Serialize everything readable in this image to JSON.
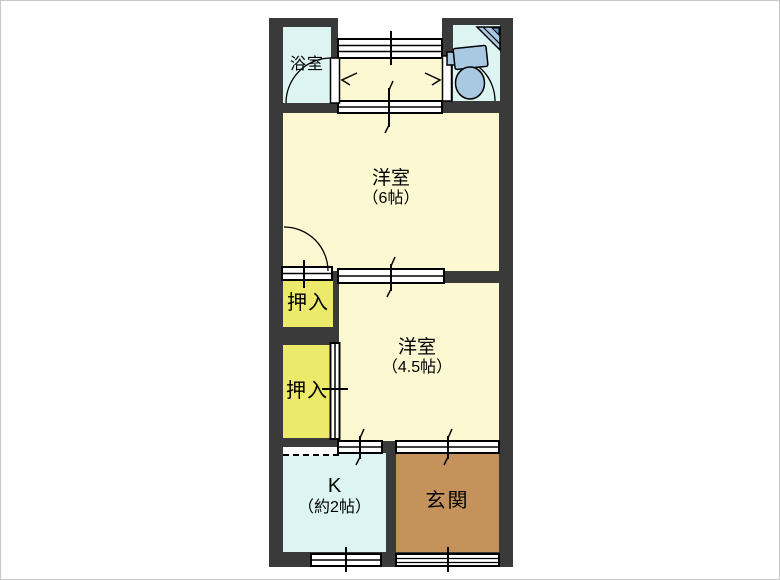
{
  "plan": {
    "type": "japanese-apartment-floorplan",
    "rooms": {
      "bathroom": {
        "label": "浴室"
      },
      "western6": {
        "name": "洋室",
        "size": "（6帖）"
      },
      "closet_upper": {
        "label": "押入"
      },
      "closet_lower": {
        "label": "押入"
      },
      "western45": {
        "name": "洋室",
        "size": "（4.5帖）"
      },
      "kitchen": {
        "name": "K",
        "size": "（約2帖）"
      },
      "entrance": {
        "label": "玄関"
      }
    },
    "fixtures": {
      "toilet": "western-toilet-icon",
      "corner_sink": "corner-hand-basin-icon"
    },
    "colors": {
      "wall": "#3a3a3a",
      "tatami_room": "#fcf9d2",
      "closet": "#ede96a",
      "wet_area": "#dcf4f2",
      "entrance": "#c5925c",
      "fixture_blue": "#a9c9e3",
      "line": "#000000",
      "background": "#ffffff"
    }
  }
}
